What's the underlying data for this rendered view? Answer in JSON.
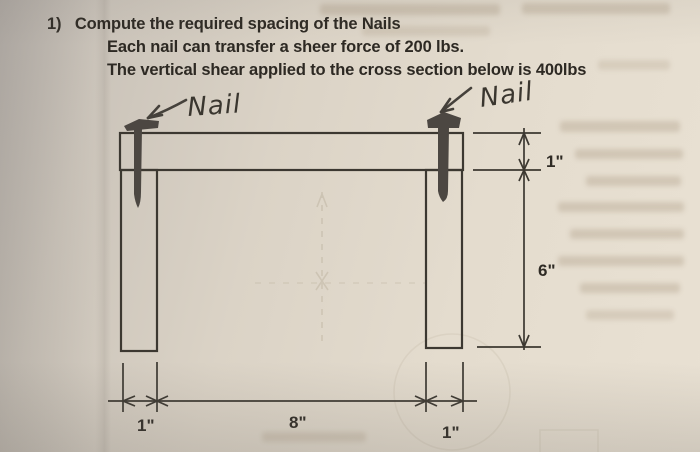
{
  "page": {
    "paper_color": "#e4dcce",
    "shadow_color": "#b9b3ad",
    "ink_color": "#2d2923",
    "drawing_line_color": "#3c3831",
    "nail_color": "#4c4742",
    "pencil_ghost_color": "#a4977f"
  },
  "problem": {
    "number": "1)",
    "title": "Compute the required spacing of the Nails",
    "line2": "Each nail can transfer a sheer force of 200 lbs.",
    "line3": "The vertical shear applied to the cross section below is 400lbs"
  },
  "figure": {
    "nail_label_left": "Nail",
    "nail_label_right": "Nail",
    "dimensions": {
      "flange_thickness": "1\"",
      "web_depth": "6\"",
      "left_web_width": "1\"",
      "web_spacing": "8\"",
      "right_web_width": "1\""
    }
  }
}
